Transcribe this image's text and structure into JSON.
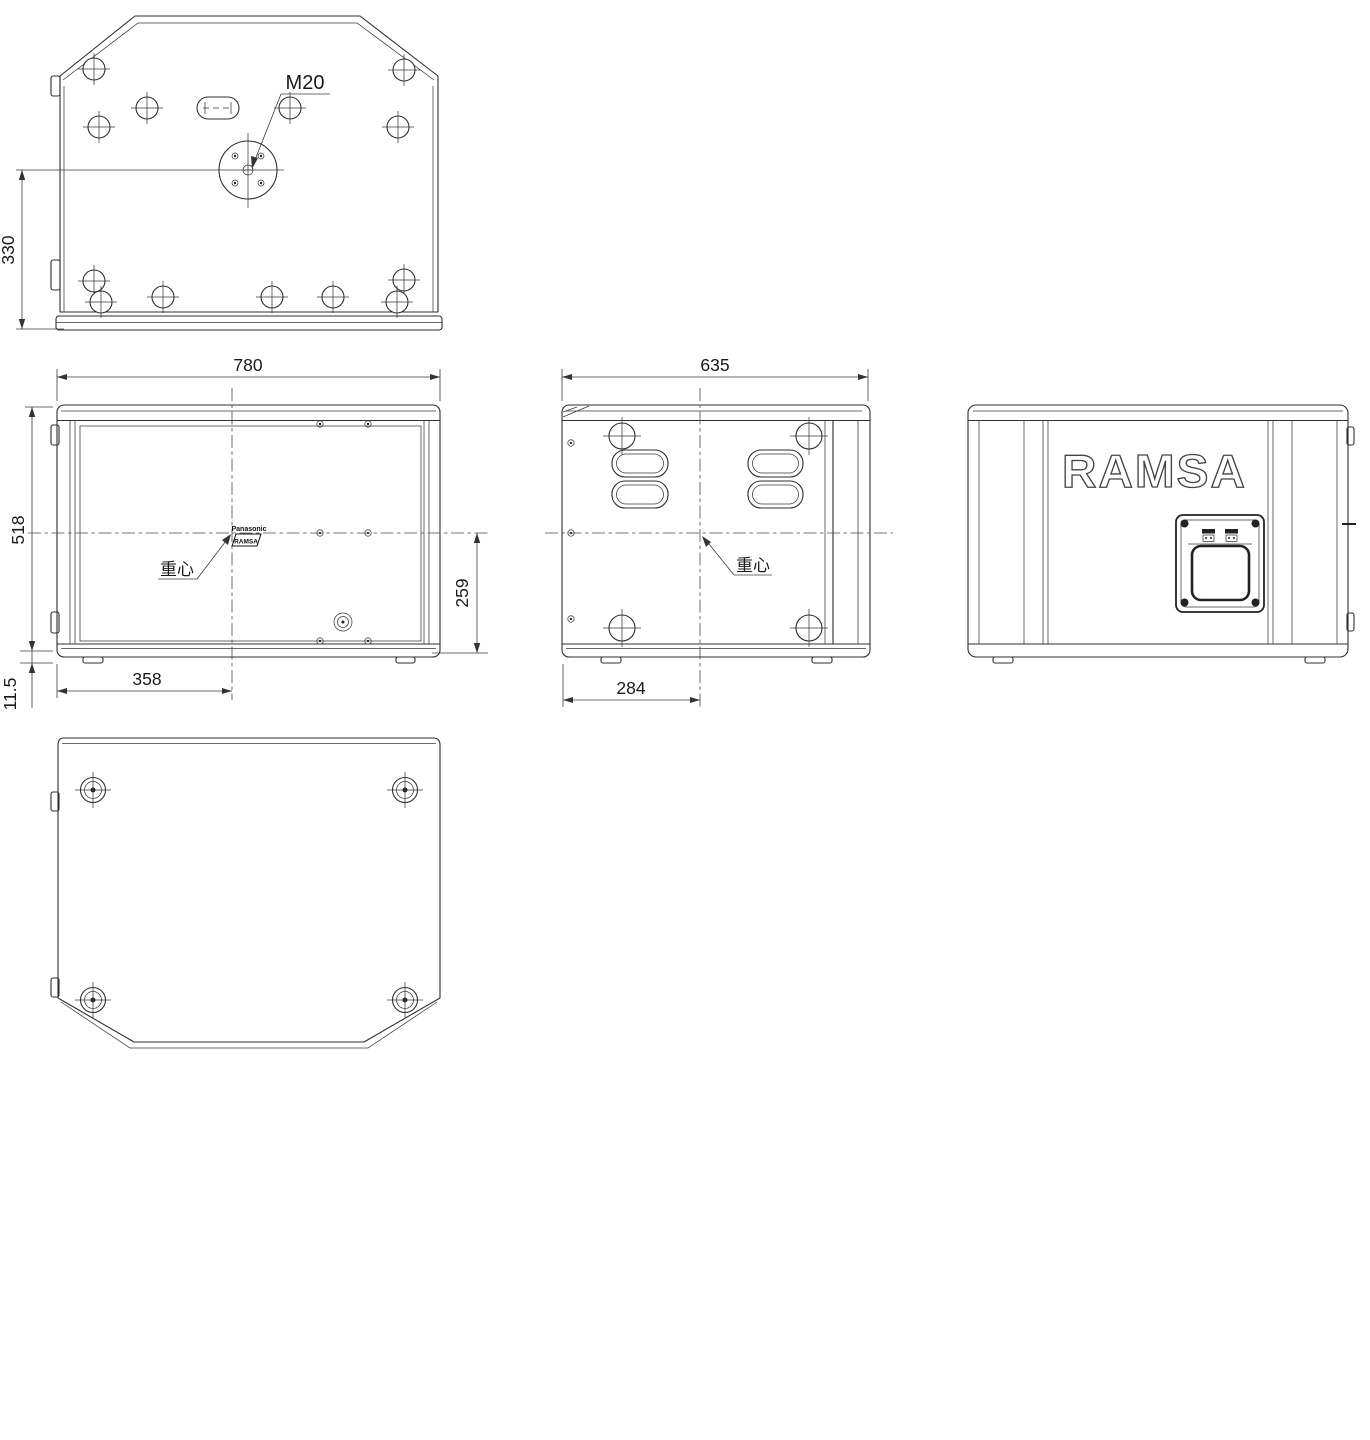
{
  "drawing": {
    "type": "multi-view mechanical dimension drawing",
    "unit_hint": "mm"
  },
  "dims": {
    "cg_offset_top": "330",
    "width": "780",
    "height": "518",
    "plinth_height": "11.5",
    "cg_from_front": "358",
    "cg_height": "259",
    "depth": "635",
    "cg_from_rear": "284"
  },
  "annotations": {
    "pole_socket": "M20",
    "center_of_gravity": "重心",
    "brand": "RAMSA",
    "mini_brand_top": "Panasonic",
    "mini_brand_bottom": "RAMSA"
  },
  "colors": {
    "line": "#2f2f2f",
    "dimension": "#3c3c3c",
    "text": "#1a1a1a",
    "background": "#ffffff"
  }
}
